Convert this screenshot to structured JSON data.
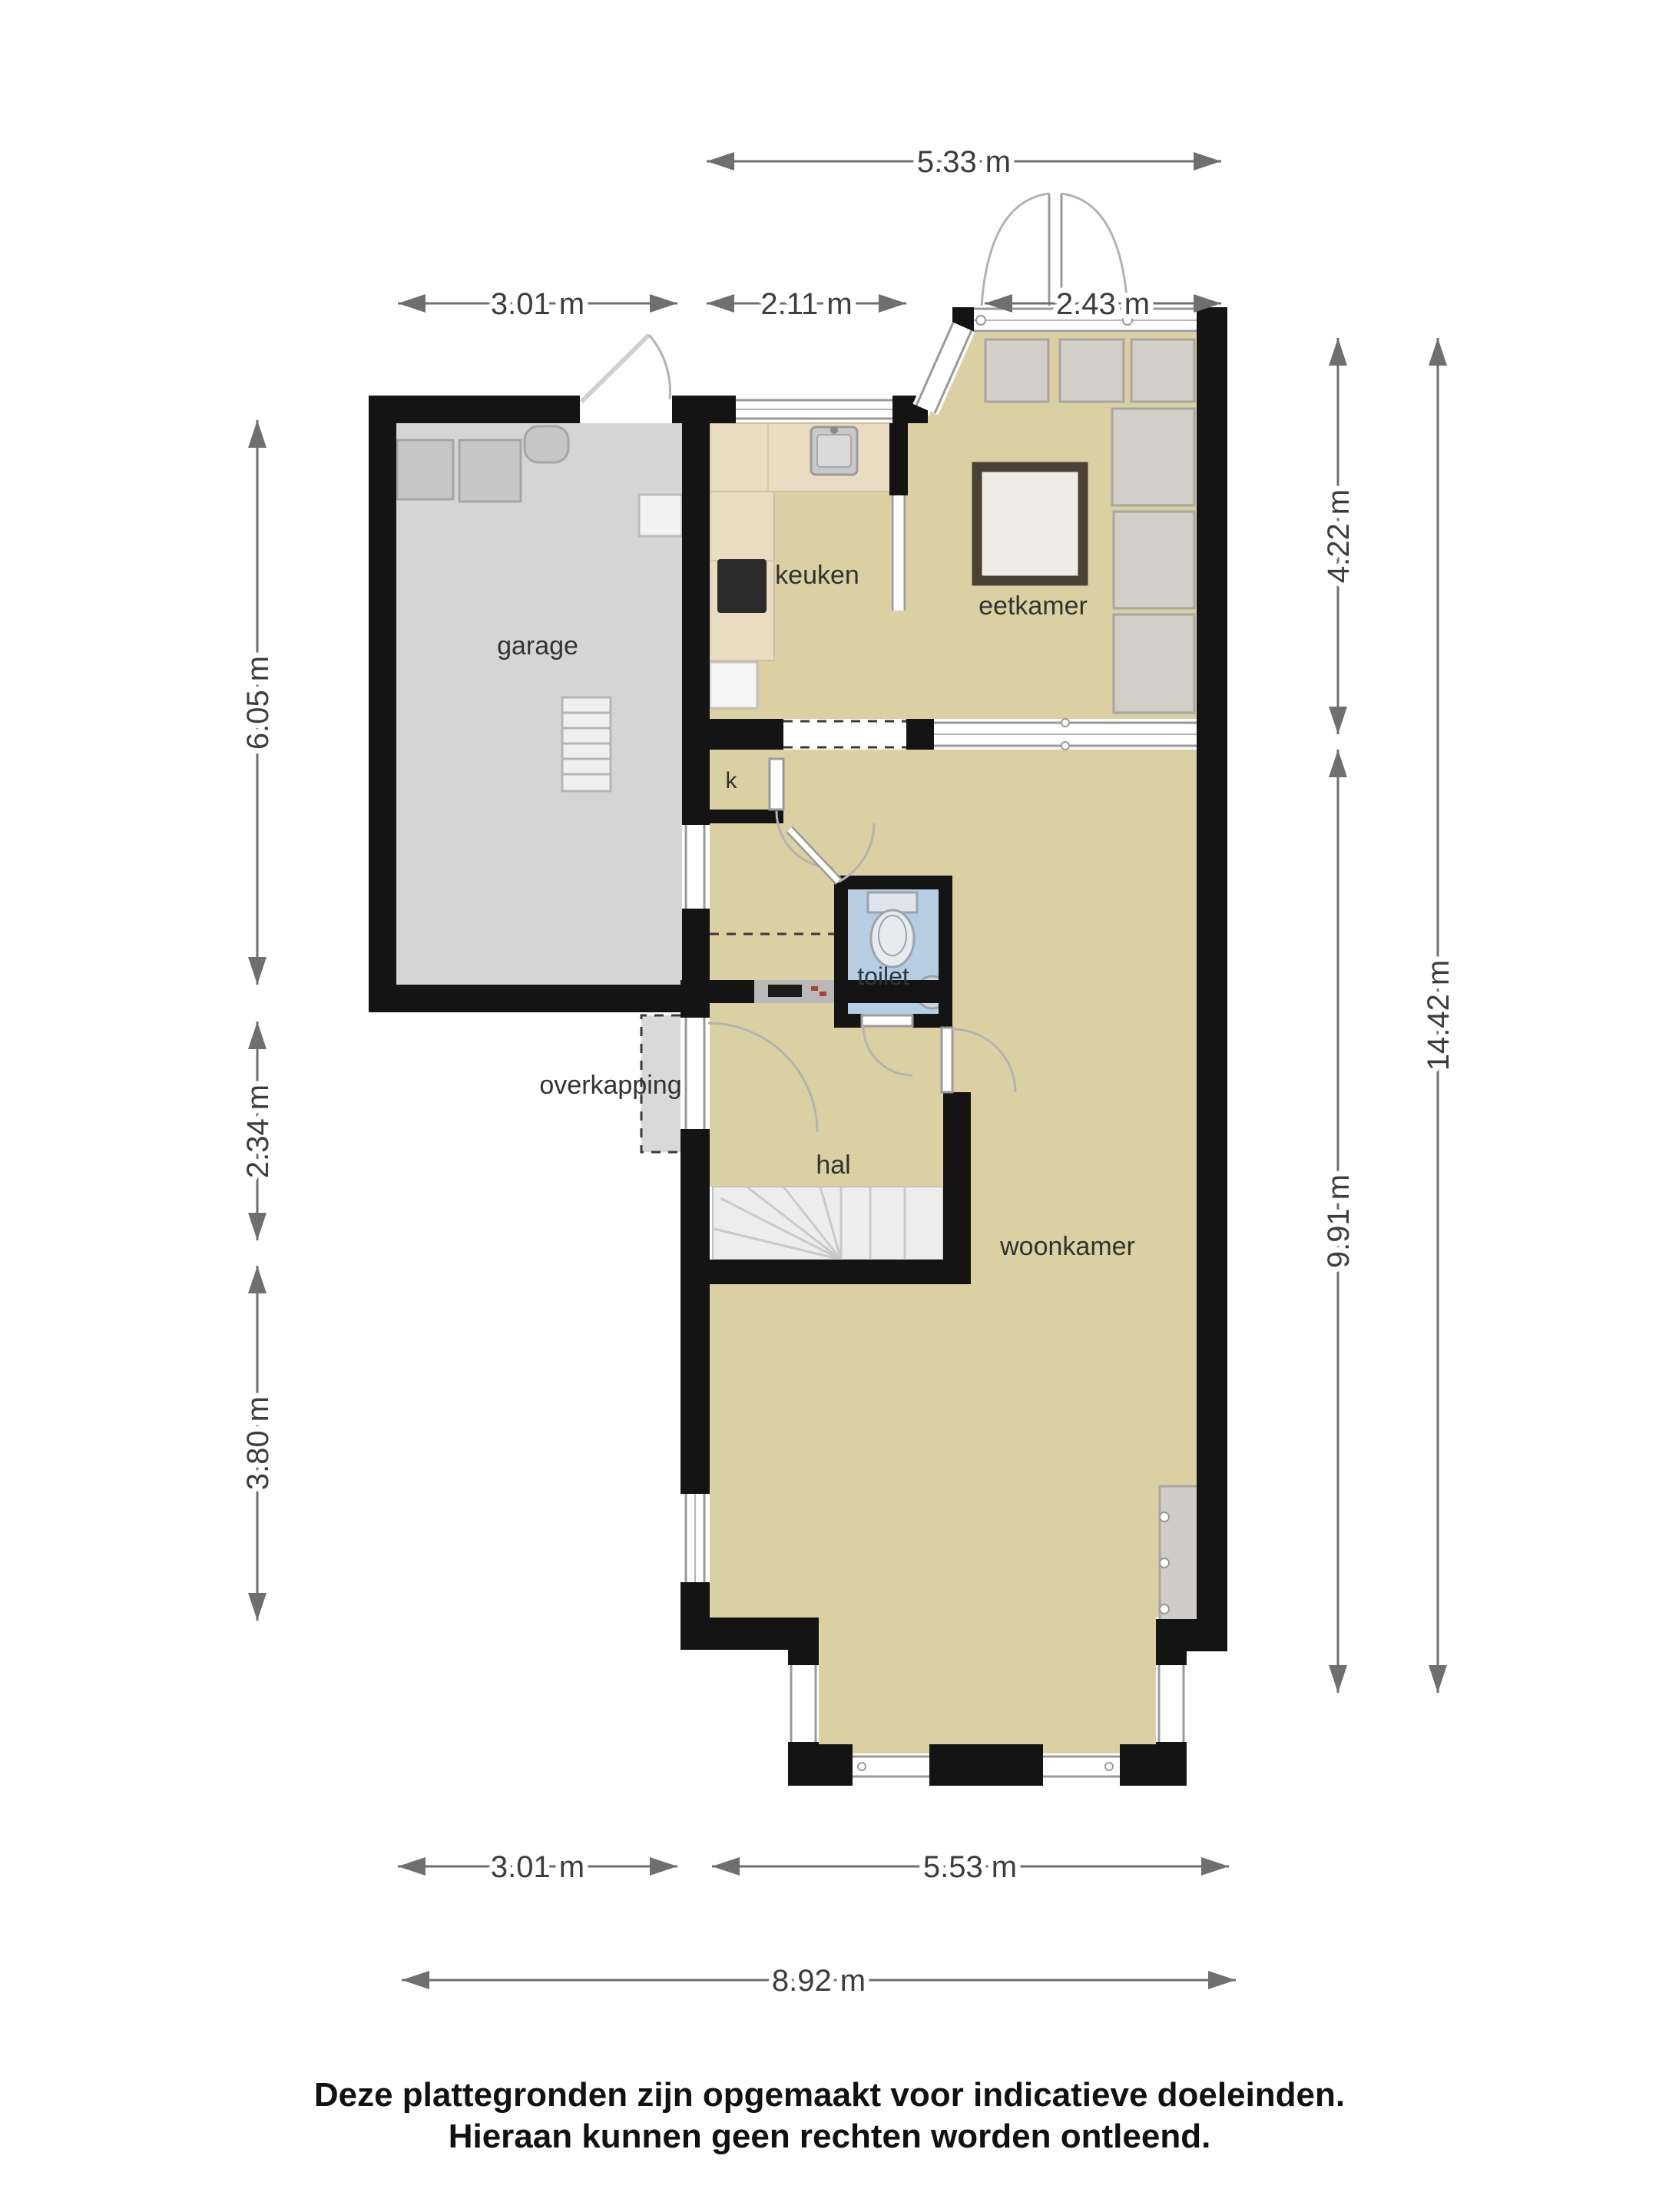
{
  "rooms": {
    "garage": "garage",
    "keuken": "keuken",
    "eetkamer": "eetkamer",
    "kast": "k",
    "toilet": "toilet",
    "overkapping": "overkapping",
    "hal": "hal",
    "woonkamer": "woonkamer"
  },
  "dims": {
    "top": {
      "total": "5.33 m",
      "garage": "3.01 m",
      "keuken": "2.11 m",
      "eetkamer": "2.43 m"
    },
    "left": {
      "garage": "6.05 m",
      "middle": "2.34 m",
      "lower": "3.80 m"
    },
    "right": {
      "upper": "4.22 m",
      "lower": "9.91 m",
      "total": "14.42 m"
    },
    "bottom": {
      "left": "3.01 m",
      "right": "5.53 m",
      "total": "8.92 m"
    }
  },
  "disclaimer": {
    "line1": "Deze plattegronden zijn opgemaakt voor indicatieve doeleinden.",
    "line2": "Hieraan kunnen geen rechten worden ontleend."
  },
  "colors": {
    "wall": "#141414",
    "floor_main": "#dbd0a2",
    "floor_garage": "#d5d5d5",
    "floor_toilet": "#b7cde2",
    "floor_stairs": "#ededed",
    "counter_wood": "#e9dcc0",
    "overkapping_gray": "#d9d9d9",
    "accent_red": "#b0402f"
  }
}
